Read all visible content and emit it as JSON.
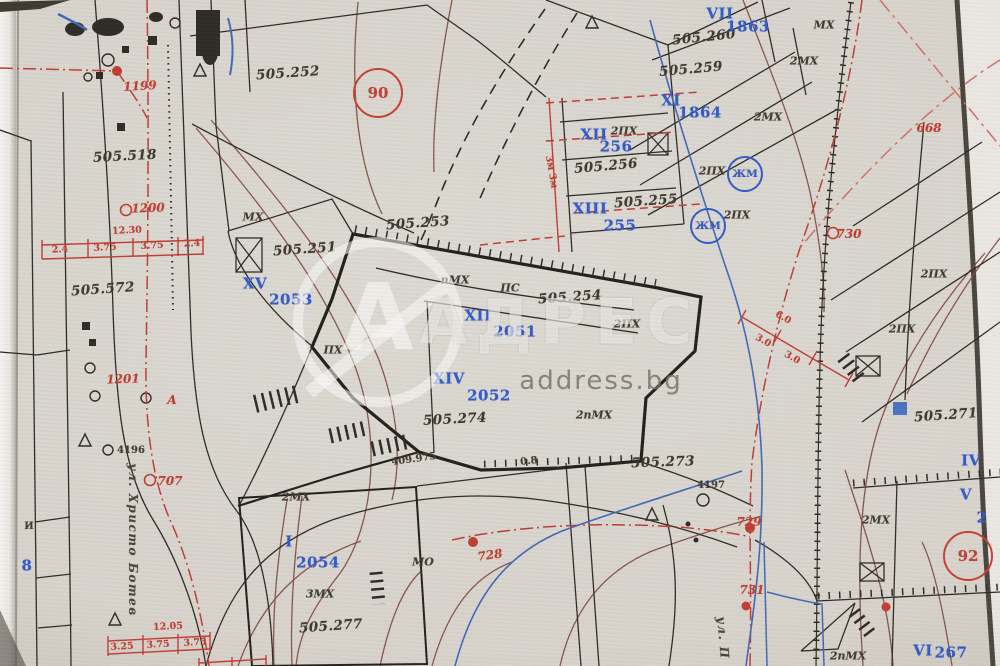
{
  "document": {
    "kind": "cadastral-map-scan"
  },
  "colors": {
    "red": "#bf3a2e",
    "blue": "#2e57c8",
    "black": "#3a352c",
    "brown": "#7b453c"
  },
  "watermark": {
    "logo_letter": "А",
    "brand": "АДРЕС",
    "domain": "address.bg"
  },
  "labels": {
    "survey": [
      {
        "t": "505.252",
        "x": 288,
        "y": 74,
        "r": -4
      },
      {
        "t": "505.518",
        "x": 125,
        "y": 157,
        "r": -3
      },
      {
        "t": "505.572",
        "x": 103,
        "y": 290,
        "r": -4
      },
      {
        "t": "505.260",
        "x": 704,
        "y": 38,
        "r": -6
      },
      {
        "t": "505.259",
        "x": 691,
        "y": 70,
        "r": -5
      },
      {
        "t": "505.256",
        "x": 606,
        "y": 167,
        "r": -5
      },
      {
        "t": "505.255",
        "x": 646,
        "y": 202,
        "r": -4
      },
      {
        "t": "505.253",
        "x": 418,
        "y": 224,
        "r": -4
      },
      {
        "t": "505.251",
        "x": 305,
        "y": 250,
        "r": -4
      },
      {
        "t": "505.254",
        "x": 570,
        "y": 298,
        "r": -4
      },
      {
        "t": "505.274",
        "x": 455,
        "y": 420,
        "r": -3
      },
      {
        "t": "505.273",
        "x": 663,
        "y": 463,
        "r": -2
      },
      {
        "t": "505.277",
        "x": 331,
        "y": 627,
        "r": -4
      },
      {
        "t": "505.271",
        "x": 946,
        "y": 416,
        "r": -4
      }
    ],
    "cadastral": [
      {
        "t": "VII",
        "x": 720,
        "y": 14
      },
      {
        "t": "1863",
        "x": 748,
        "y": 27
      },
      {
        "t": "XI",
        "x": 671,
        "y": 101
      },
      {
        "t": "1864",
        "x": 700,
        "y": 113
      },
      {
        "t": "XII",
        "x": 594,
        "y": 135
      },
      {
        "t": "256",
        "x": 616,
        "y": 147
      },
      {
        "t": "XIII",
        "x": 590,
        "y": 209
      },
      {
        "t": "255",
        "x": 620,
        "y": 226
      },
      {
        "t": "XV",
        "x": 255,
        "y": 284
      },
      {
        "t": "2053",
        "x": 291,
        "y": 300
      },
      {
        "t": "XII",
        "x": 478,
        "y": 316
      },
      {
        "t": "2051",
        "x": 515,
        "y": 332
      },
      {
        "t": "XIV",
        "x": 449,
        "y": 379
      },
      {
        "t": "2052",
        "x": 489,
        "y": 396
      },
      {
        "t": "I",
        "x": 289,
        "y": 542
      },
      {
        "t": "2054",
        "x": 318,
        "y": 563
      },
      {
        "t": "IV",
        "x": 971,
        "y": 461
      },
      {
        "t": "V",
        "x": 966,
        "y": 495
      },
      {
        "t": "2",
        "x": 982,
        "y": 518
      },
      {
        "t": "VI",
        "x": 923,
        "y": 651
      },
      {
        "t": "267",
        "x": 951,
        "y": 653
      },
      {
        "t": "8",
        "x": 27,
        "y": 566
      }
    ],
    "building": [
      {
        "t": "МХ",
        "x": 253,
        "y": 217
      },
      {
        "t": "МХ",
        "x": 824,
        "y": 25
      },
      {
        "t": "2МХ",
        "x": 804,
        "y": 61
      },
      {
        "t": "2МХ",
        "x": 768,
        "y": 117
      },
      {
        "t": "2ПХ",
        "x": 624,
        "y": 131
      },
      {
        "t": "2ПХ",
        "x": 712,
        "y": 171
      },
      {
        "t": "2ПХ",
        "x": 737,
        "y": 215
      },
      {
        "t": "пМХ",
        "x": 455,
        "y": 280
      },
      {
        "t": "ПС",
        "x": 510,
        "y": 288
      },
      {
        "t": "2ПХ",
        "x": 627,
        "y": 324
      },
      {
        "t": "ПХ",
        "x": 333,
        "y": 350
      },
      {
        "t": "2пМХ",
        "x": 594,
        "y": 415
      },
      {
        "t": "2ПХ",
        "x": 934,
        "y": 274
      },
      {
        "t": "2ПХ",
        "x": 902,
        "y": 329
      },
      {
        "t": "2МХ",
        "x": 296,
        "y": 497
      },
      {
        "t": "3МХ",
        "x": 320,
        "y": 594
      },
      {
        "t": "МО",
        "x": 423,
        "y": 562
      },
      {
        "t": "2МХ",
        "x": 876,
        "y": 520
      },
      {
        "t": "2пМХ",
        "x": 848,
        "y": 656
      }
    ],
    "regulation": [
      {
        "t": "1199",
        "x": 140,
        "y": 86,
        "r": -3
      },
      {
        "t": "1200",
        "x": 148,
        "y": 208,
        "r": -2
      },
      {
        "t": "1201",
        "x": 123,
        "y": 379,
        "r": -2
      },
      {
        "t": "707",
        "x": 170,
        "y": 481
      },
      {
        "t": "668",
        "x": 929,
        "y": 128
      },
      {
        "t": "730",
        "x": 849,
        "y": 234
      },
      {
        "t": "728",
        "x": 490,
        "y": 555,
        "r": -8
      },
      {
        "t": "729",
        "x": 749,
        "y": 522
      },
      {
        "t": "731",
        "x": 752,
        "y": 590
      },
      {
        "t": "А",
        "x": 172,
        "y": 400
      }
    ],
    "dims": [
      {
        "t": "12.30",
        "x": 127,
        "y": 231,
        "r": -3
      },
      {
        "t": "2.4",
        "x": 60,
        "y": 250,
        "r": -3
      },
      {
        "t": "3.75",
        "x": 105,
        "y": 248,
        "r": -3
      },
      {
        "t": "3.75",
        "x": 152,
        "y": 246,
        "r": -3
      },
      {
        "t": "2.4",
        "x": 192,
        "y": 244,
        "r": -3
      },
      {
        "t": "12.05",
        "x": 168,
        "y": 627,
        "r": -3
      },
      {
        "t": "3.25",
        "x": 122,
        "y": 647,
        "r": -3
      },
      {
        "t": "3.75",
        "x": 158,
        "y": 645,
        "r": -3
      },
      {
        "t": "3.75",
        "x": 195,
        "y": 643,
        "r": -3
      },
      {
        "t": "6.0",
        "x": 783,
        "y": 318,
        "r": 30
      },
      {
        "t": "3.0",
        "x": 763,
        "y": 341,
        "r": 30
      },
      {
        "t": "3.0",
        "x": 792,
        "y": 358,
        "r": 30
      },
      {
        "t": "3м 3м",
        "x": 551,
        "y": 172,
        "r": 80
      }
    ],
    "notes": [
      {
        "t": "4196",
        "x": 131,
        "y": 451
      },
      {
        "t": "4197",
        "x": 711,
        "y": 486
      },
      {
        "t": "0.8",
        "x": 529,
        "y": 462,
        "r": -6
      },
      {
        "t": "409.975",
        "x": 414,
        "y": 460,
        "r": -8
      },
      {
        "t": "И",
        "x": 29,
        "y": 527
      }
    ],
    "streets": [
      {
        "t": "ул. Христо Ботев",
        "x": 133,
        "y": 540,
        "r": 90
      },
      {
        "t": "ул. П",
        "x": 723,
        "y": 638,
        "r": 85
      }
    ],
    "circled": [
      {
        "t": "90",
        "x": 378,
        "y": 93,
        "d": 46,
        "c": "red"
      },
      {
        "t": "92",
        "x": 968,
        "y": 556,
        "d": 46,
        "c": "red"
      },
      {
        "t": "ЖМ",
        "x": 745,
        "y": 174,
        "d": 32,
        "c": "blue"
      },
      {
        "t": "ЖМ",
        "x": 708,
        "y": 226,
        "d": 32,
        "c": "blue"
      }
    ]
  }
}
